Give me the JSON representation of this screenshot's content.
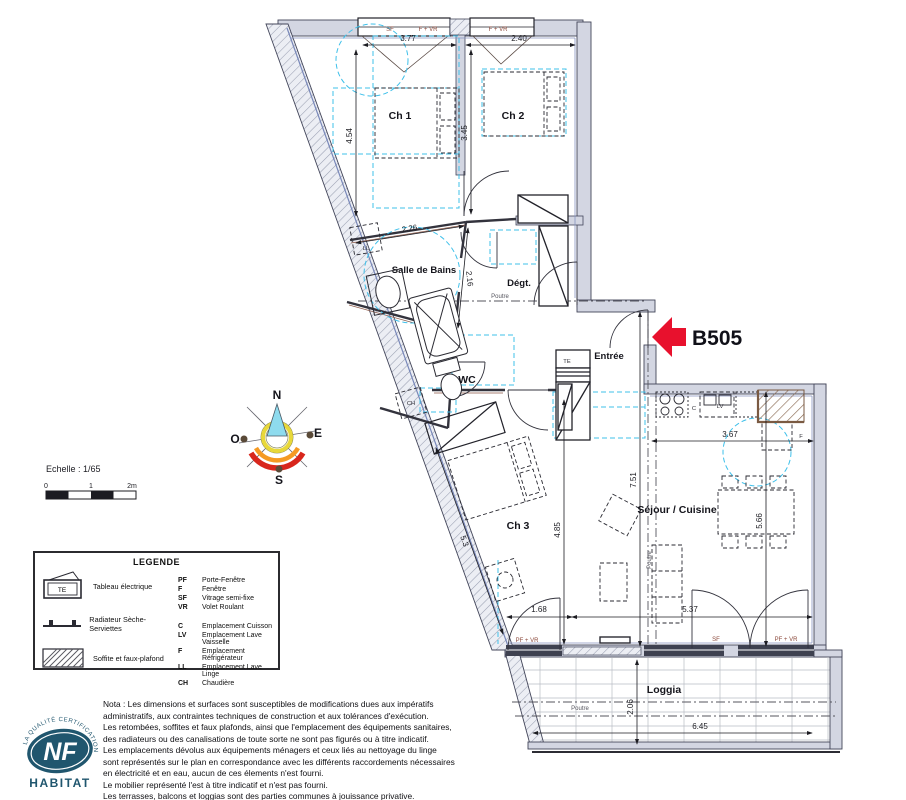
{
  "unit": {
    "label": "B505"
  },
  "rooms": {
    "ch1": "Ch 1",
    "ch2": "Ch 2",
    "sdb": "Salle de Bains",
    "degt": "Dégt.",
    "wc": "WC",
    "entree": "Entrée",
    "ch3": "Ch 3",
    "sejour": "Séjour / Cuisine",
    "loggia": "Loggia"
  },
  "dims": {
    "ch1_w": "3.77",
    "ch2_w": "2.40",
    "ch1_h": "4.54",
    "ch2_h": "3.45",
    "sdb_w": "2.26",
    "sdb_d": "2.16",
    "cuisine_w": "3.67",
    "sejour_h": "7.51",
    "sejour_mid_h": "5.66",
    "ch3_h": "4.85",
    "ch3_w": "1.68",
    "sejour_w": "5.37",
    "ch3_diag": "5.3",
    "loggia_d": "2.06",
    "loggia_w": "6.45"
  },
  "openings": {
    "sf": "SF",
    "f_vr": "F + VR",
    "pf_vr": "PF + VR"
  },
  "equipment": {
    "ll": "LL",
    "ch": "CH",
    "te": "TE",
    "c": "C",
    "lv": "LV",
    "f": "F"
  },
  "beam_label": "Poutre",
  "compass": {
    "n": "N",
    "e": "E",
    "s": "S",
    "o": "O"
  },
  "scale_bar": {
    "title": "Echelle : 1/65",
    "t0": "0",
    "t1": "1",
    "t2": "2m"
  },
  "legend": {
    "title": "LEGENDE",
    "te_symbol": "TE",
    "symbols": [
      {
        "label": "Tableau électrique"
      },
      {
        "label": "Radiateur Sèche-Serviettes"
      },
      {
        "label": "Soffite et faux-plafond"
      }
    ],
    "abbreviations": [
      {
        "abbr": "PF",
        "label": "Porte-Fenêtre"
      },
      {
        "abbr": "F",
        "label": "Fenêtre"
      },
      {
        "abbr": "SF",
        "label": "Vitrage semi-fixe"
      },
      {
        "abbr": "VR",
        "label": "Volet Roulant"
      },
      {
        "abbr": "C",
        "label": "Emplacement Cuisson"
      },
      {
        "abbr": "LV",
        "label": "Emplacement Lave Vaisselle"
      },
      {
        "abbr": "F",
        "label": "Emplacement Réfrigérateur"
      },
      {
        "abbr": "LL",
        "label": "Emplacement Lave Linge"
      },
      {
        "abbr": "CH",
        "label": "Chaudière"
      }
    ]
  },
  "nota": {
    "lines": [
      "Nota : Les dimensions et surfaces sont susceptibles de modifications dues aux impératifs",
      "administratifs, aux contraintes techniques de construction et aux tolérances d'exécution.",
      "Les retombées, soffites et faux plafonds, ainsi que l'emplacement des équipements sanitaires,",
      "des radiateurs ou des canalisations de toute sorte ne sont pas figurés ou à titre indicatif.",
      "Les emplacements dévolus aux équipements ménagers et ceux liés au nettoyage du linge",
      "sont représentés sur le plan en correspondance avec les différents raccordements nécessaires",
      "en électricité et en eau, aucun de ces élements n'est fourni.",
      "Le mobilier représenté l'est à titre indicatif et n'est pas fourni.",
      "Les terrasses, balcons et loggias sont des parties communes à jouissance privative."
    ]
  },
  "logo": {
    "nf": "NF",
    "habitat": "HABITAT",
    "arc_text": "LA QUALITÉ CERTIFICATION"
  },
  "colors": {
    "arrow_red": "#e8112d",
    "ceiling_cyan": "#3fc0ea",
    "wall_fill": "#d3d6e2",
    "nf_blue": "#20566e"
  }
}
